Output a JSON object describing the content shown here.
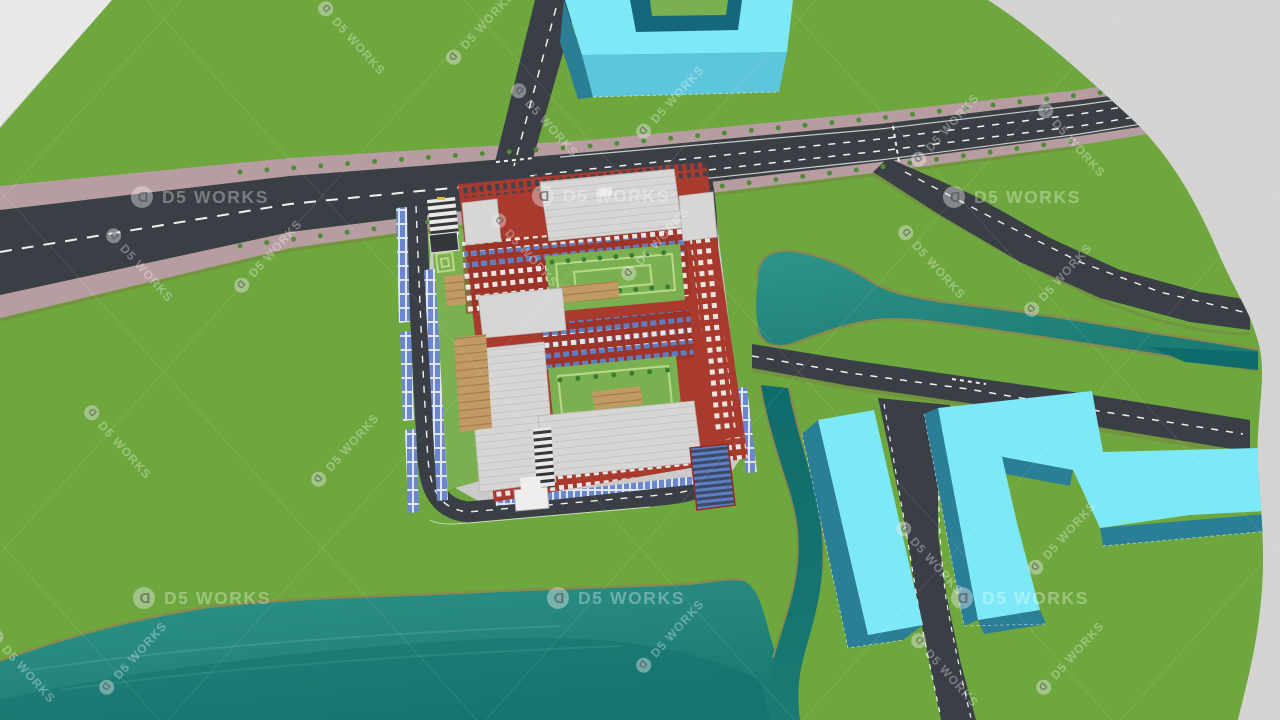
{
  "app": {
    "view_title": "3D architectural site render",
    "scene_elements": [
      "terrain",
      "lake",
      "river",
      "stream",
      "arterial-road",
      "side-roads",
      "red-campus-building",
      "cyan-massing-buildings",
      "blue-panel-fences",
      "entrance-gate",
      "parking-canopy",
      "courtyards"
    ]
  },
  "watermark": {
    "text": "D5 WORKS",
    "logo_icon": "d5-pin-logo",
    "logo_glyph": "D",
    "opacity": 0.32,
    "large": [
      {
        "x": 200,
        "y": 197
      },
      {
        "x": 601,
        "y": 196
      },
      {
        "x": 1012,
        "y": 197
      },
      {
        "x": 202,
        "y": 598
      },
      {
        "x": 616,
        "y": 598
      },
      {
        "x": 1020,
        "y": 598
      }
    ],
    "diagonal": [
      {
        "x": 352,
        "y": 38,
        "dir": "desc"
      },
      {
        "x": 480,
        "y": 28,
        "dir": "asc"
      },
      {
        "x": 545,
        "y": 120,
        "dir": "desc"
      },
      {
        "x": 670,
        "y": 102,
        "dir": "asc"
      },
      {
        "x": 945,
        "y": 130,
        "dir": "asc"
      },
      {
        "x": 1072,
        "y": 140,
        "dir": "desc"
      },
      {
        "x": 140,
        "y": 265,
        "dir": "desc"
      },
      {
        "x": 268,
        "y": 256,
        "dir": "asc"
      },
      {
        "x": 525,
        "y": 250,
        "dir": "desc"
      },
      {
        "x": 655,
        "y": 244,
        "dir": "asc"
      },
      {
        "x": 932,
        "y": 262,
        "dir": "desc"
      },
      {
        "x": 1058,
        "y": 280,
        "dir": "asc"
      },
      {
        "x": 118,
        "y": 442,
        "dir": "desc"
      },
      {
        "x": 345,
        "y": 450,
        "dir": "asc"
      },
      {
        "x": 930,
        "y": 558,
        "dir": "desc"
      },
      {
        "x": 1062,
        "y": 538,
        "dir": "asc"
      },
      {
        "x": 22,
        "y": 666,
        "dir": "desc"
      },
      {
        "x": 133,
        "y": 658,
        "dir": "asc"
      },
      {
        "x": 670,
        "y": 636,
        "dir": "asc"
      },
      {
        "x": 945,
        "y": 670,
        "dir": "desc"
      },
      {
        "x": 1070,
        "y": 658,
        "dir": "asc"
      }
    ]
  },
  "colors": {
    "bg": "#d5d3d2",
    "wedge": "#eae8e7",
    "terrain": "#6fa73f",
    "sidewalk": "#b79da1",
    "road": "#3a3f45",
    "roadLine": "#f0f0ee",
    "roadShadow": "#77843f",
    "bank": "#878c4c",
    "water1": "#2f9488",
    "water2": "#1b7a73",
    "waterDeep": "#0e6b6b",
    "plinth": "#cbcac8",
    "brick": "#a93a2e",
    "brickDark": "#8f2d25",
    "roof": "#d8d6d4",
    "roofEdge": "#b9b7b5",
    "court": "#7bb050",
    "hedge": "#b8d98a",
    "tree": "#3c7c31",
    "treeSide": "#4e8c38",
    "wood": "#c29a64",
    "glassBlue": "#5d7ec2",
    "glassDark": "#3d4a66",
    "panelLight": "#dfe5f2",
    "fenceBlue": "#6b87cf",
    "canopy": "#ebe9e7",
    "canopyDark": "#34373c",
    "gate": "#efeeec",
    "cyanTop": "#7de9f8",
    "cyanFace": "#5ec6dc",
    "cyanDark": "#2a7f96",
    "cyanInner": "#16677c",
    "winWhite": "#e9e5e1",
    "winDark": "#43414e"
  }
}
